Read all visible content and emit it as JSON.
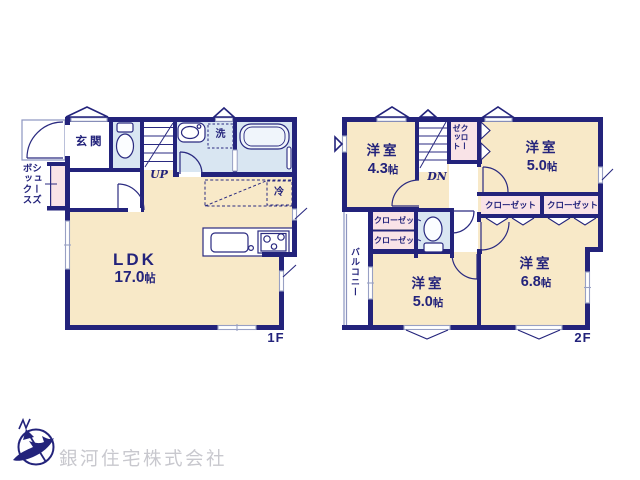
{
  "colors": {
    "wall_navy": "#23237b",
    "room_cream": "#f8e9c8",
    "wet_area_blue": "#d9e6f2",
    "closet_pink": "#f9e3e7",
    "window_gray": "#98a0c4",
    "watermark_gray": "#c8c8ce"
  },
  "floor1": {
    "label": "1F",
    "ldk": {
      "name": "LDK",
      "size": "17.0",
      "unit": "帖"
    },
    "entrance": "玄関",
    "stairs": "UP",
    "laundry": "洗",
    "fridge": "冷",
    "shoebox_line1": "シューズ",
    "shoebox_line2": "ボックス"
  },
  "floor2": {
    "label": "2F",
    "room_top_left": {
      "name": "洋室",
      "size": "4.3",
      "unit": "帖"
    },
    "room_top_right": {
      "name": "洋室",
      "size": "5.0",
      "unit": "帖"
    },
    "room_bottom_middle": {
      "name": "洋室",
      "size": "5.0",
      "unit": "帖"
    },
    "room_bottom_right": {
      "name": "洋室",
      "size": "6.8",
      "unit": "帖"
    },
    "stairs": "DN",
    "hall_closet_line1": "クロー",
    "hall_closet_line2": "ゼット",
    "closet_b1": "クローゼット",
    "closet_b2": "クローゼット",
    "closet_m1": "クローゼット",
    "closet_m2": "クローゼット",
    "balcony": "バルコニー"
  },
  "watermark": "銀河住宅株式会社"
}
